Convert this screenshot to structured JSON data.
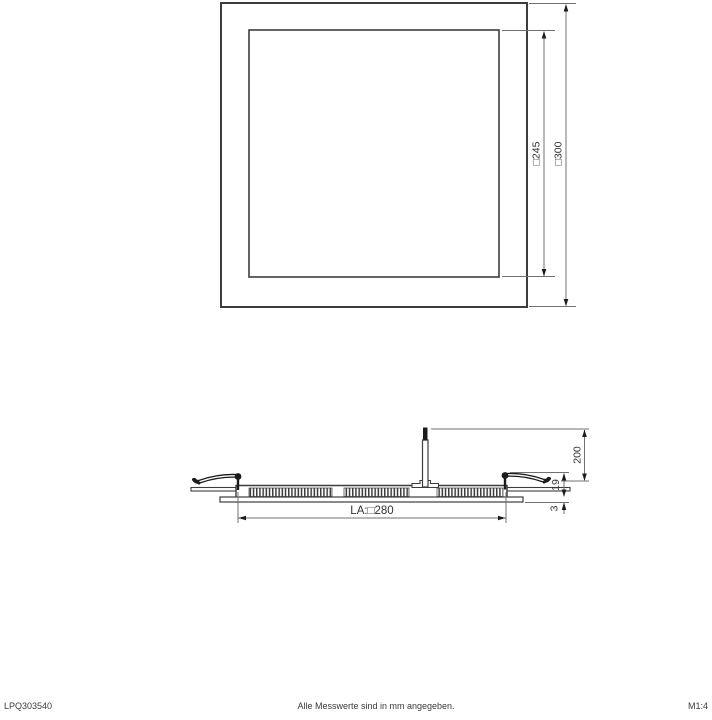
{
  "drawing": {
    "footer": {
      "product_code": "LPQ303540",
      "note": "Alle Messwerte sind in mm angegeben.",
      "scale": "M1:4"
    },
    "dimensions": {
      "panel_outer": "□300",
      "panel_inner": "□245",
      "suspension_height": "200",
      "recess_depth": "19",
      "frame_protrusion": "3",
      "cutout": "LA:□280"
    },
    "colors": {
      "line": "#3d3d3d",
      "dim_line": "#707070",
      "text": "#333333",
      "solid_fill": "#1c1c1c"
    }
  }
}
